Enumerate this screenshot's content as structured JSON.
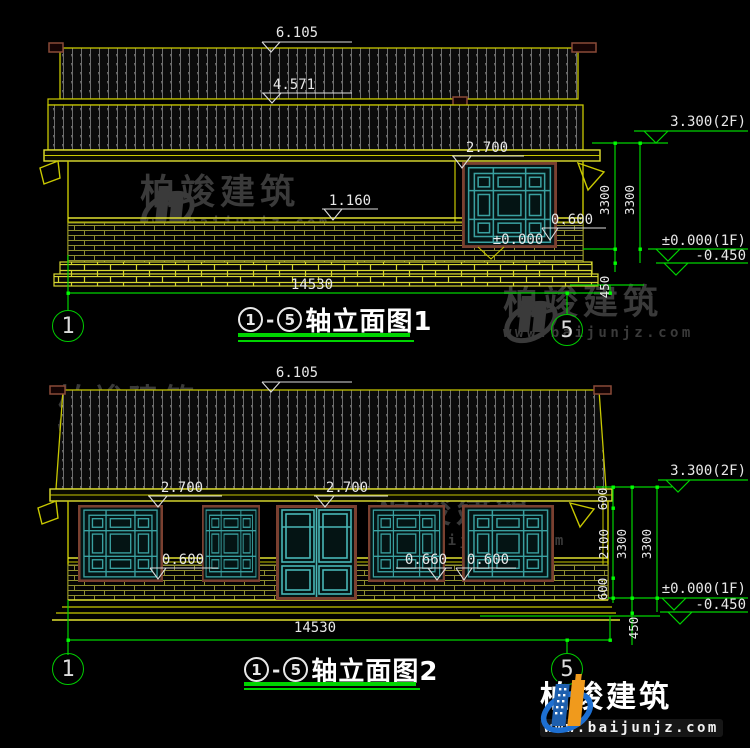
{
  "watermark": {
    "brand": "柏竣建筑",
    "url": "www.baijunjz.com"
  },
  "footer": {
    "brand": "柏竣建筑",
    "url": "www.baijunjz.com"
  },
  "colors": {
    "dim_green": "#00d400",
    "line_yellow": "#c8c800",
    "lattice_teal": "#3aa0a0",
    "text_white": "#e8e8e8"
  },
  "elev1": {
    "title": "轴立面图1",
    "axis_start": "1",
    "axis_end": "5",
    "dash": "-",
    "dims": {
      "ridge": "6.105",
      "tier2": "4.571",
      "window_top": "2.700",
      "sill": "1.160",
      "plinth": "0.600",
      "ground": "±0.000",
      "overall_width": "14530"
    },
    "levels": {
      "roof": "3.300(2F)",
      "story_a": "3300",
      "story_b": "3300",
      "floor": "±0.000(1F)",
      "below_grade": "-0.450",
      "plinth_height": "450"
    }
  },
  "elev2": {
    "title": "轴立面图2",
    "axis_start": "1",
    "axis_end": "5",
    "dash": "-",
    "dims": {
      "ridge": "6.105",
      "window_top_left": "2.700",
      "window_top_right": "2.700",
      "sill_left": "0.600",
      "sill_mid": "0.660",
      "sill_right": "0.600",
      "overall_width": "14530"
    },
    "levels": {
      "roof": "3.300(2F)",
      "seg_top": "600",
      "seg_mid": "2100",
      "seg_bottom": "600",
      "story_a": "3300",
      "story_b": "3300",
      "floor": "±0.000(1F)",
      "below_grade": "-0.450",
      "plinth_height": "450"
    }
  }
}
